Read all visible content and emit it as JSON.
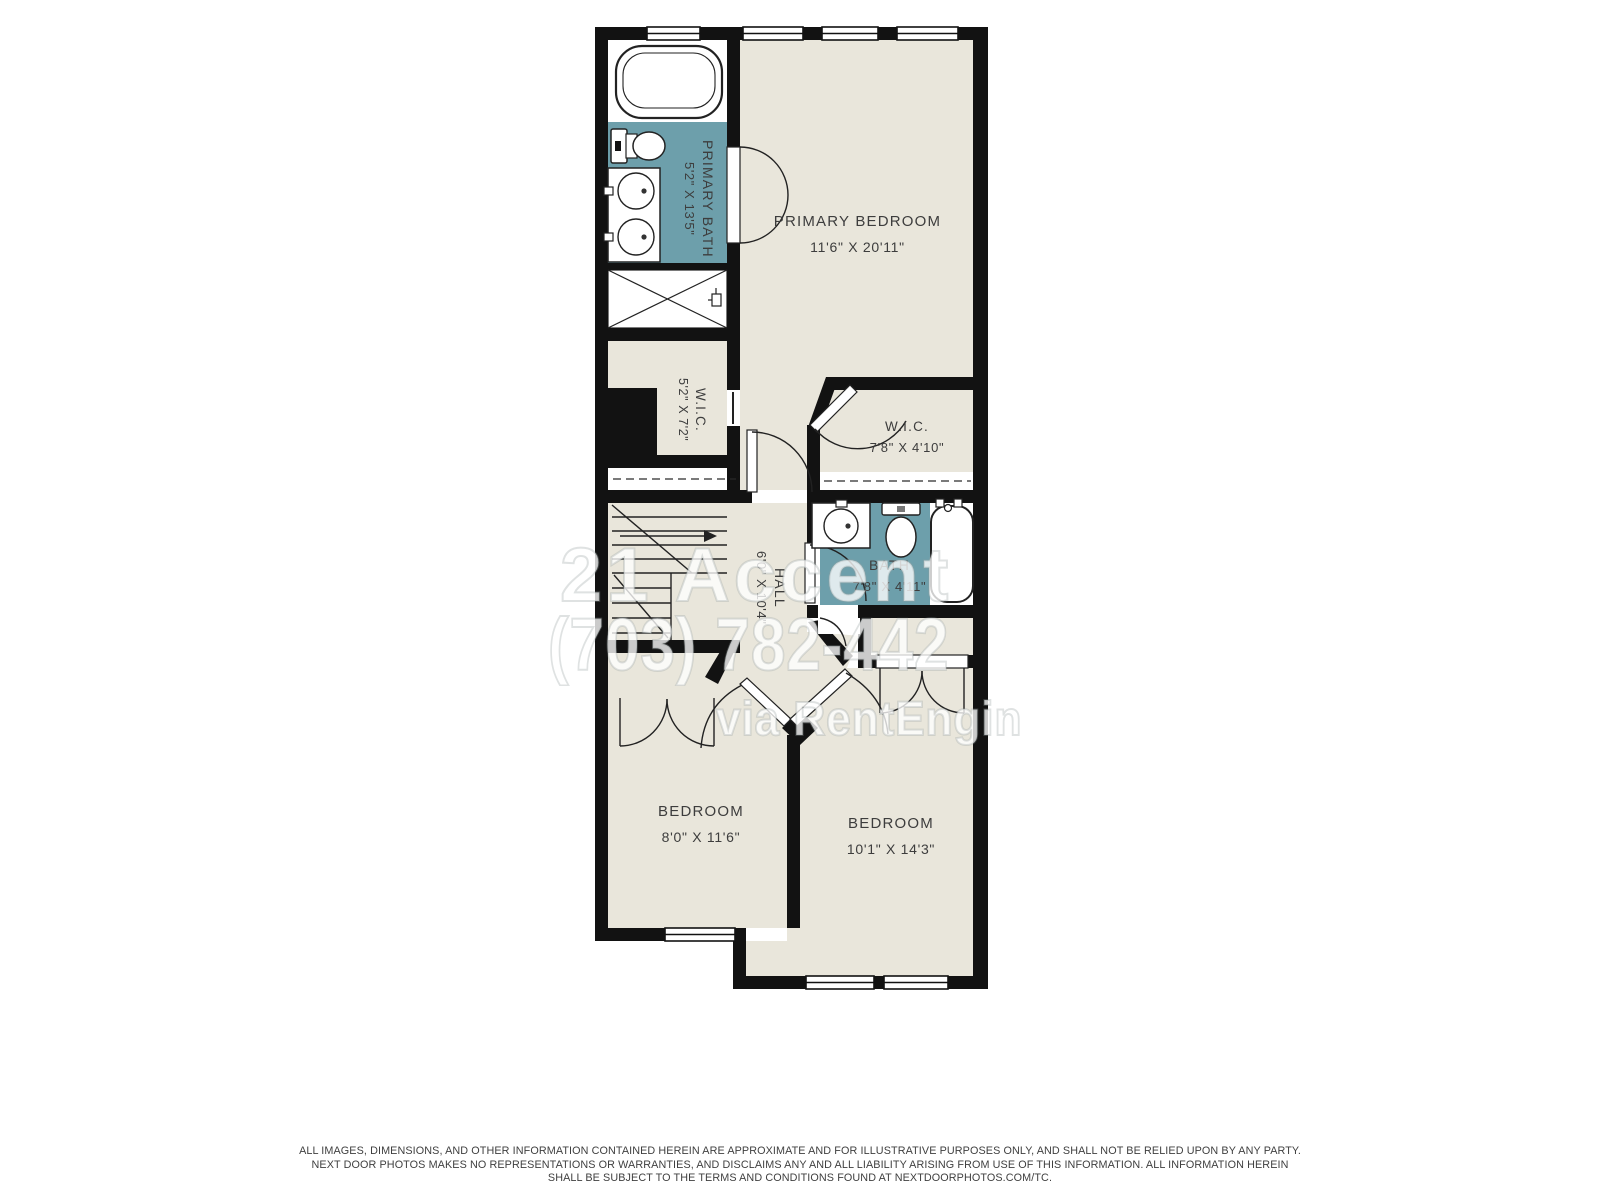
{
  "floor_plan": {
    "rooms": [
      {
        "id": "primary_bath",
        "name": "PRIMARY BATH",
        "dimensions": "5'2\" X 13'5\""
      },
      {
        "id": "primary_bedroom",
        "name": "PRIMARY BEDROOM",
        "dimensions": "11'6\" X 20'11\""
      },
      {
        "id": "wic_left",
        "name": "W.I.C.",
        "dimensions": "5'2\" X 7'2\""
      },
      {
        "id": "wic_right",
        "name": "W.I.C.",
        "dimensions": "7'8\" X 4'10\""
      },
      {
        "id": "bath",
        "name": "BATH",
        "dimensions": "7'8\" X 4'11\""
      },
      {
        "id": "hall",
        "name": "HALL",
        "dimensions": "6'0\" X 10'4\""
      },
      {
        "id": "bedroom_left",
        "name": "BEDROOM",
        "dimensions": "8'0\" X 11'6\""
      },
      {
        "id": "bedroom_right",
        "name": "BEDROOM",
        "dimensions": "10'1\" X 14'3\""
      }
    ],
    "fixtures": [
      "bathtub-icon",
      "toilet-icon",
      "double-sink-vanity-icon",
      "shower-icon",
      "sink-icon",
      "stairs-icon",
      "window-icon",
      "door-swing-icon",
      "closet-rod-dashed-line"
    ],
    "colors": {
      "floor": "#e9e6db",
      "wet_room_floor": "#6d9fab",
      "walls": "#121212",
      "fixture_fill": "#ffffff",
      "label_text": "#3d3d3d",
      "background": "#ffffff"
    }
  },
  "watermark": {
    "line1": "21 Accent",
    "line2": "(703) 782-442",
    "line3": "via RentEngin"
  },
  "disclaimer": {
    "line1": "ALL IMAGES, DIMENSIONS, AND OTHER INFORMATION CONTAINED HEREIN ARE APPROXIMATE AND FOR ILLUSTRATIVE PURPOSES ONLY, AND SHALL NOT BE RELIED UPON BY ANY PARTY.",
    "line2": "NEXT DOOR PHOTOS MAKES NO REPRESENTATIONS OR WARRANTIES, AND DISCLAIMS ANY AND ALL LIABILITY ARISING FROM USE OF THIS INFORMATION. ALL INFORMATION HEREIN",
    "line3": "SHALL BE SUBJECT TO THE TERMS AND CONDITIONS FOUND AT NEXTDOORPHOTOS.COM/TC."
  }
}
